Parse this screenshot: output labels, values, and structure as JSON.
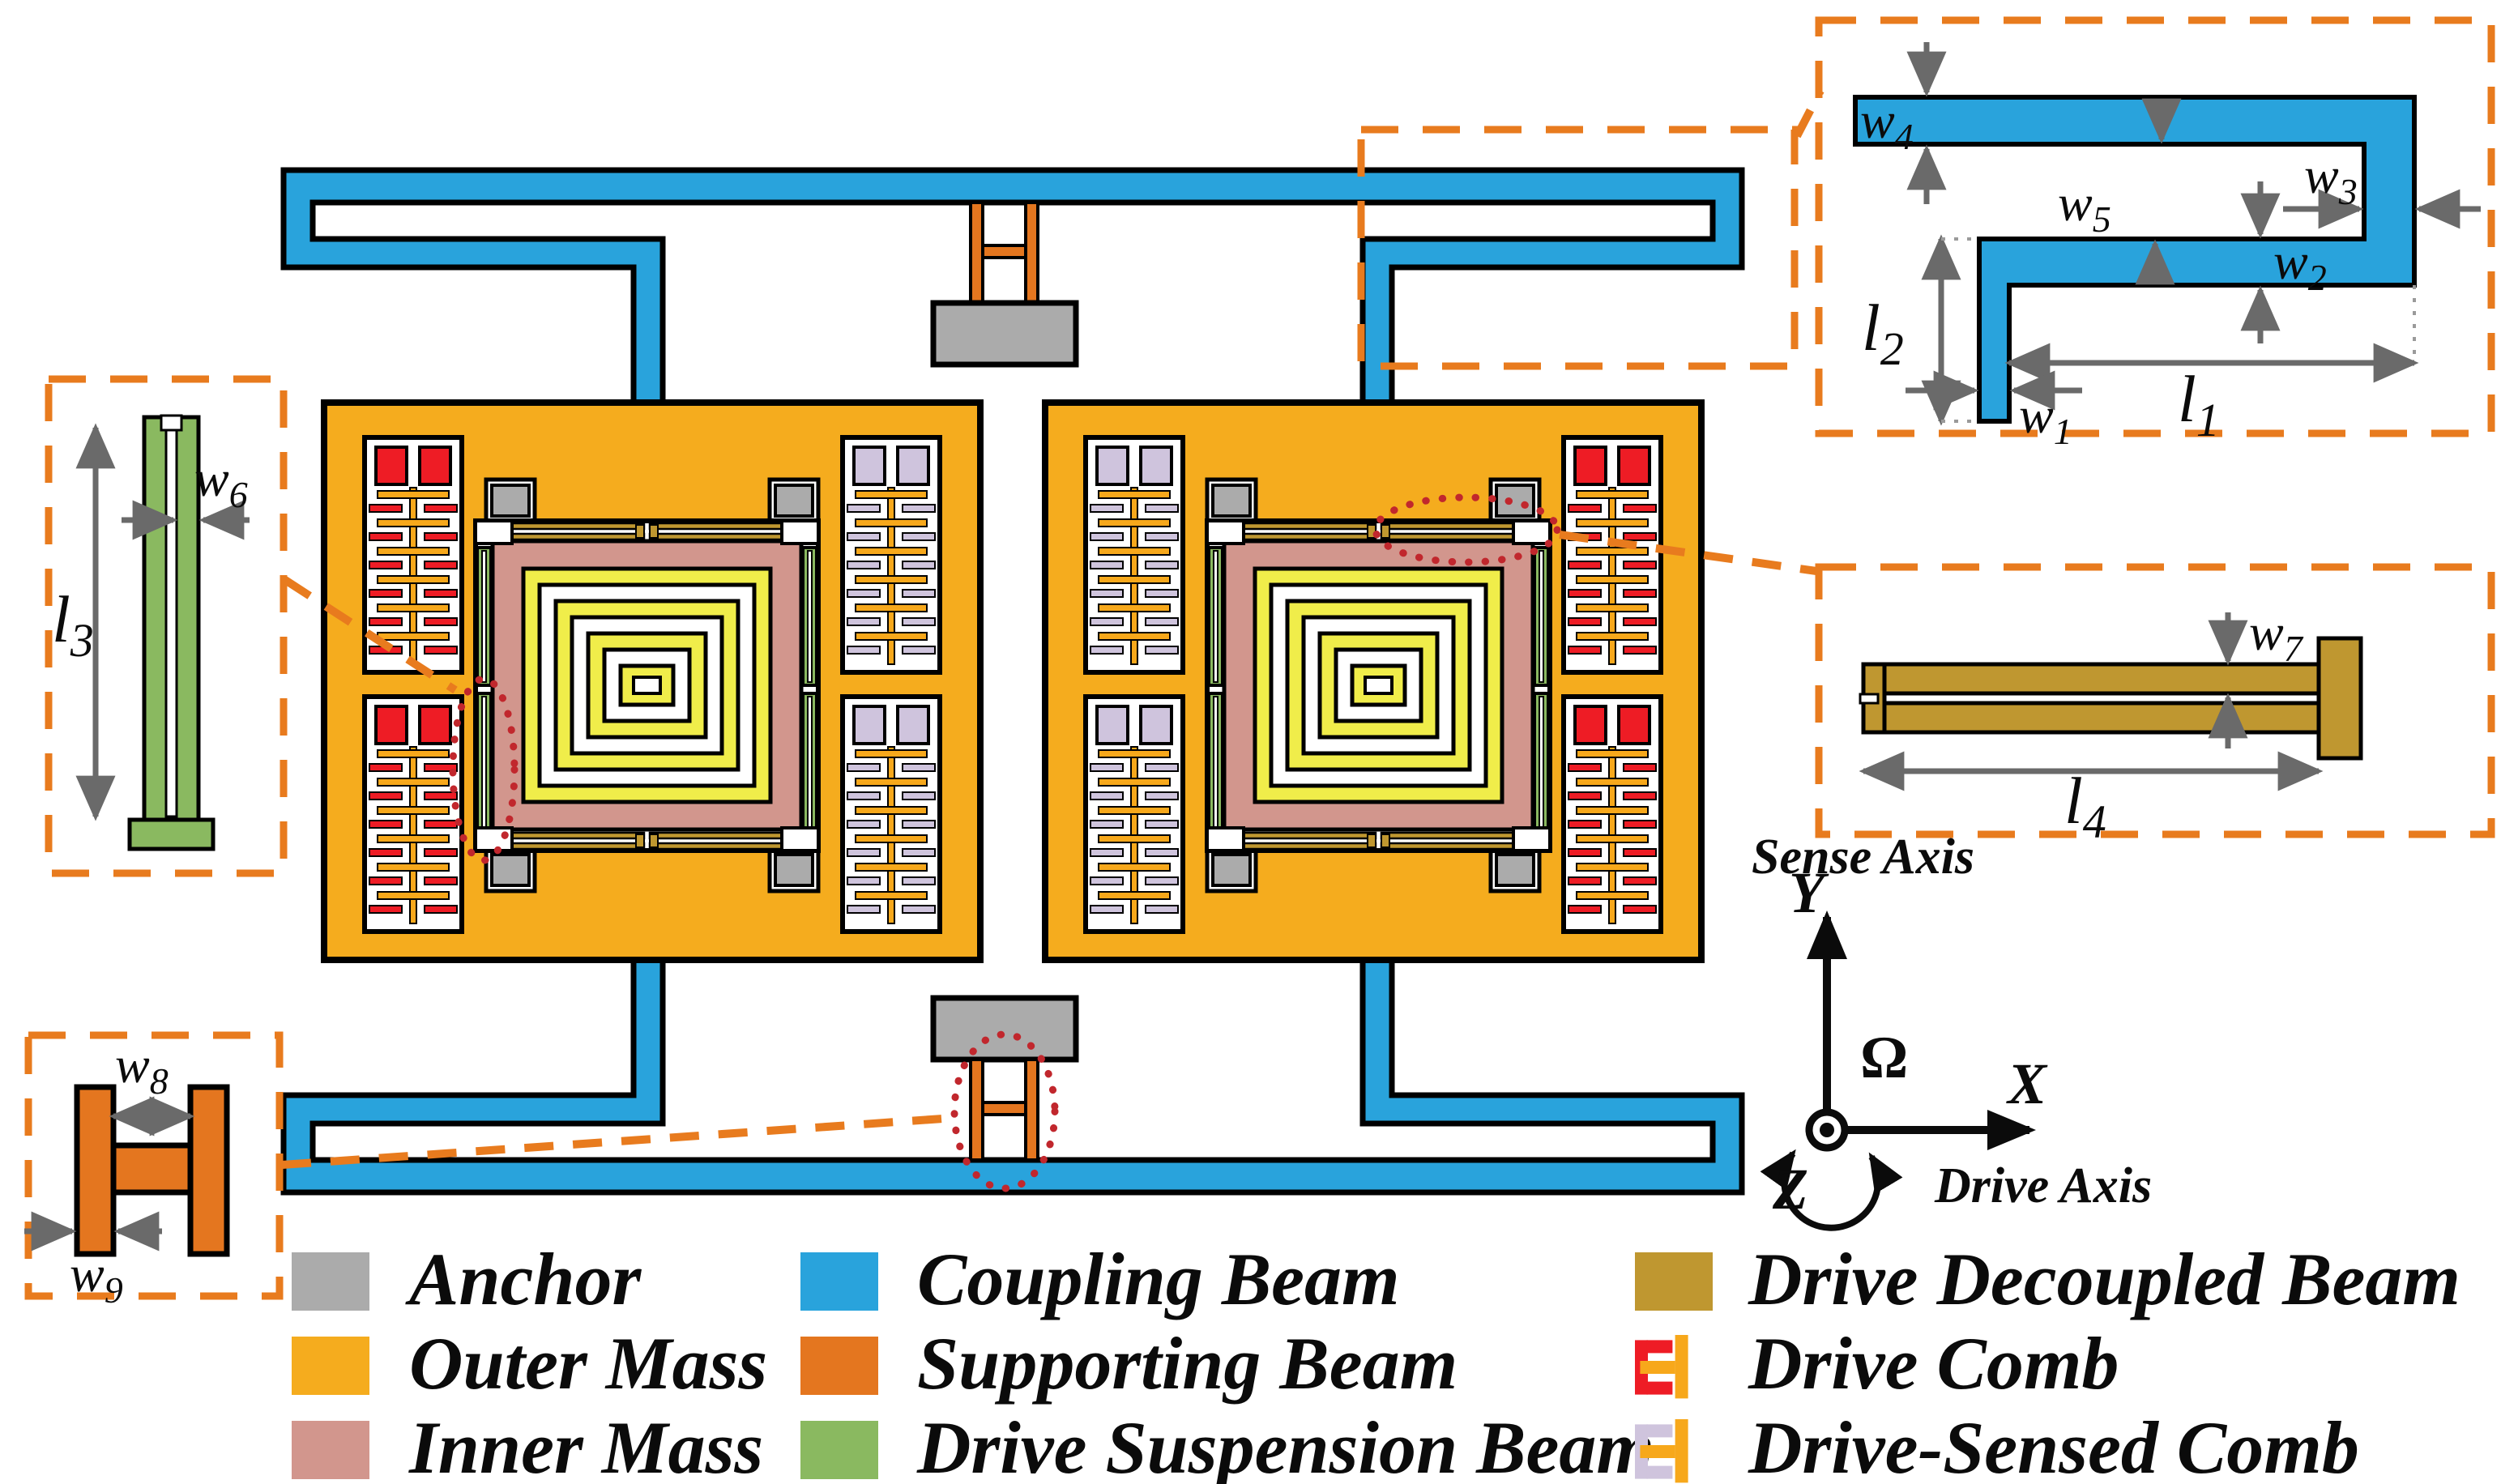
{
  "dims": {
    "w1": {
      "base": "w",
      "sub": "1"
    },
    "w2": {
      "base": "w",
      "sub": "2"
    },
    "w3": {
      "base": "w",
      "sub": "3"
    },
    "w4": {
      "base": "w",
      "sub": "4"
    },
    "w5": {
      "base": "w",
      "sub": "5"
    },
    "w6": {
      "base": "w",
      "sub": "6"
    },
    "w7": {
      "base": "w",
      "sub": "7"
    },
    "w8": {
      "base": "w",
      "sub": "8"
    },
    "w9": {
      "base": "w",
      "sub": "9"
    },
    "l1": {
      "base": "l",
      "sub": "1"
    },
    "l2": {
      "base": "l",
      "sub": "2"
    },
    "l3": {
      "base": "l",
      "sub": "3"
    },
    "l4": {
      "base": "l",
      "sub": "4"
    }
  },
  "axes": {
    "sense": "Sense Axis",
    "drive": "Drive Axis",
    "x": "X",
    "y": "Y",
    "z": "Z",
    "omega": "Ω"
  },
  "legend": {
    "items": [
      {
        "id": "anchor",
        "label": "Anchor",
        "color": "#ABABAB",
        "swatch": "square"
      },
      {
        "id": "outer-mass",
        "label": "Outer Mass",
        "color": "#F5AC1E",
        "swatch": "square"
      },
      {
        "id": "inner-mass",
        "label": "Inner Mass",
        "color": "#D2968D",
        "swatch": "square"
      },
      {
        "id": "coupling-beam",
        "label": "Coupling Beam",
        "color": "#29A3DC",
        "swatch": "square"
      },
      {
        "id": "supporting-beam",
        "label": "Supporting Beam",
        "color": "#E4761F",
        "swatch": "square"
      },
      {
        "id": "drive-suspension-beam",
        "label": "Drive Suspension Beam",
        "color": "#8AB960",
        "swatch": "square"
      },
      {
        "id": "drive-decoupled-beam",
        "label": "Drive Decoupled Beam",
        "color": "#BF9730",
        "swatch": "square"
      },
      {
        "id": "drive-comb",
        "label": "Drive Comb",
        "color": "#EE1C25",
        "swatch": "comb"
      },
      {
        "id": "drive-sensed-comb",
        "label": "Drive-Sensed Comb",
        "color": "#CFC4DD",
        "swatch": "comb"
      }
    ]
  },
  "colors": {
    "outer_mass": "#F5AC1E",
    "inner_mass": "#D2968D",
    "coupling_beam": "#29A3DC",
    "supporting_beam": "#E4761F",
    "suspension_beam": "#8AB960",
    "decoupled_beam": "#BF9730",
    "drive_comb": "#EE1C25",
    "drive_sensed_comb": "#CFC4DD",
    "anchor": "#ABABAB",
    "ring_yellow": "#F0ED4A",
    "comb_spine": "#F7A81B",
    "annotation_red": "#C1272D",
    "annotation_orange": "#E87B1E",
    "dim_gray": "#6A6A6A"
  }
}
